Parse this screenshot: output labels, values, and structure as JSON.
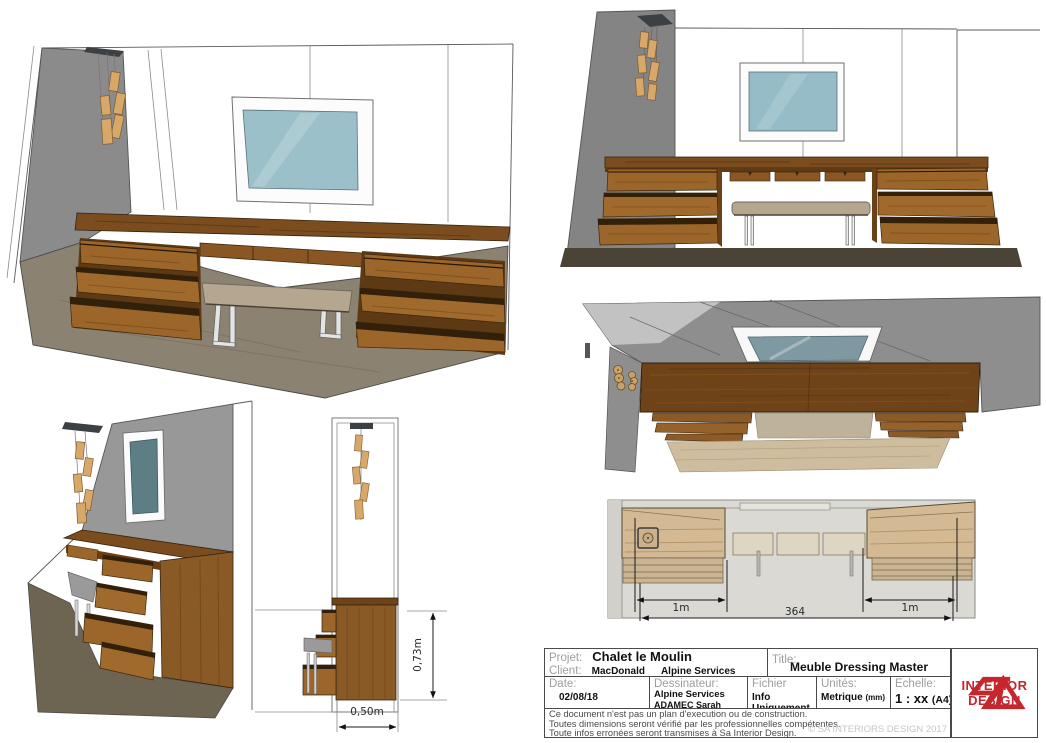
{
  "dims": {
    "side_width": "0,50m",
    "side_height": "0,73m",
    "plan_left": "1m",
    "plan_total": "364",
    "plan_right": "1m"
  },
  "title_block": {
    "projet_label": "Projet:",
    "projet_value": "Chalet le Moulin",
    "client_label": "Client:",
    "client_value_1": "MacDonald",
    "client_value_2": "Alpine Services",
    "title_label": "Title:",
    "title_value": "Meuble Dressing Master",
    "date_label": "Date:",
    "date_value": "02/08/18",
    "dessinateur_label": "Dessinateur:",
    "dessinateur_value_1": "Alpine Services",
    "dessinateur_value_2": "ADAMEC Sarah",
    "fichier_label": "Fichier",
    "fichier_value": "Info Uniquement",
    "unites_label": "Unités:",
    "unites_value": "Metrique",
    "unites_suffix": "(mm)",
    "echelle_label": "Echelle:",
    "echelle_value": "1 : xx",
    "echelle_suffix": "(A4)",
    "disclaimer_line_1": "Ce document n'est pas un plan d'execution ou de construction.",
    "disclaimer_line_2": "Toutes dimensions seront vérifié par les professionnelles compétentes.",
    "disclaimer_line_3": "Toute infos erronées seront transmises à Sa Interior Design.",
    "copyright": "© SA INTERIORS DESIGN 2017"
  },
  "logo": {
    "line_1": "INTERIOR",
    "line_2": "DESIGN"
  },
  "colors": {
    "logo_red": "#c5272e",
    "wood_counter": "#7b4c1d",
    "wood_drawer": "#9c6529",
    "wall_gray": "#8b8b8b",
    "mirror_glass": "#95bcc7",
    "bench_fabric": "#b4a68f",
    "floor_dark": "#4b4335",
    "floor_light": "#cdbd9e",
    "pendant_wood": "#d8a86a"
  }
}
